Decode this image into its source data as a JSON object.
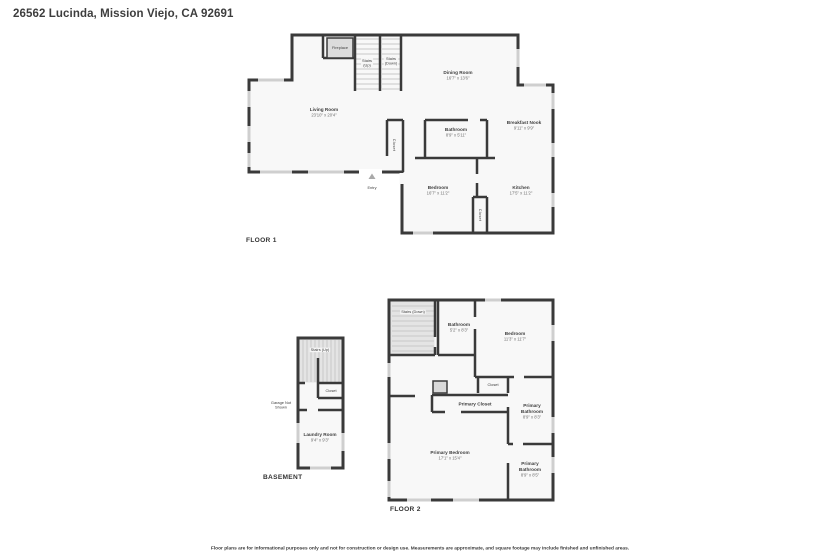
{
  "page": {
    "title": "26562 Lucinda, Mission Viejo, CA 92691",
    "footer": "Floor plans are for informational purposes only and not for construction or design use. Measurements are approximate, and square footage may include finished and unfinished areas."
  },
  "floor1": {
    "label": "FLOOR 1",
    "rooms": [
      {
        "name": "Living Room",
        "dims": "23'10\" x 20'4\""
      },
      {
        "name": "Dining Room",
        "dims": "16'7\" x 13'6\""
      },
      {
        "name": "Breakfast Nook",
        "dims": "9'11\" x 9'9\""
      },
      {
        "name": "Bathroom",
        "dims": "8'9\" x 5'11\""
      },
      {
        "name": "Bedroom",
        "dims": "16'7\" x 11'2\""
      },
      {
        "name": "Kitchen",
        "dims": "17'5\" x 11'2\""
      }
    ],
    "features": {
      "fireplace": "Fireplace",
      "stairs_up_l1": "Stairs",
      "stairs_up_l2": "(Up)",
      "stairs_down_l1": "Stairs",
      "stairs_down_l2": "(Down)",
      "closet_hall": "Closet",
      "closet_kitchen": "Closet",
      "entry": "Entry"
    }
  },
  "basement": {
    "label": "BASEMENT",
    "rooms": [
      {
        "name": "Laundry Room",
        "dims": "9'4\" x 9'3\""
      }
    ],
    "features": {
      "stairs_up": "Stairs (Up)",
      "closet": "Closet",
      "garage_note_l1": "Garage Not",
      "garage_note_l2": "Shown"
    }
  },
  "floor2": {
    "label": "FLOOR 2",
    "rooms": [
      {
        "name": "Bathroom",
        "dims": "5'2\" x 8'3\""
      },
      {
        "name": "Bedroom",
        "dims": "11'3\" x 11'7\""
      },
      {
        "name": "Primary Bedroom",
        "dims": "17'1\" x 15'4\""
      },
      {
        "name": "Primary Bathroom",
        "dims": "8'9\" x 8'3\""
      },
      {
        "name": "Primary Bathroom",
        "dims": "8'9\" x 8'5\""
      }
    ],
    "features": {
      "stairs_down": "Stairs (Down)",
      "closet": "Closet",
      "primary_closet": "Primary Closet"
    }
  },
  "colors": {
    "wall": "#3a3a3a",
    "room_fill": "#f8f8f8",
    "stairs_fill": "#e4e4e4",
    "window": "#cfcfcf"
  }
}
